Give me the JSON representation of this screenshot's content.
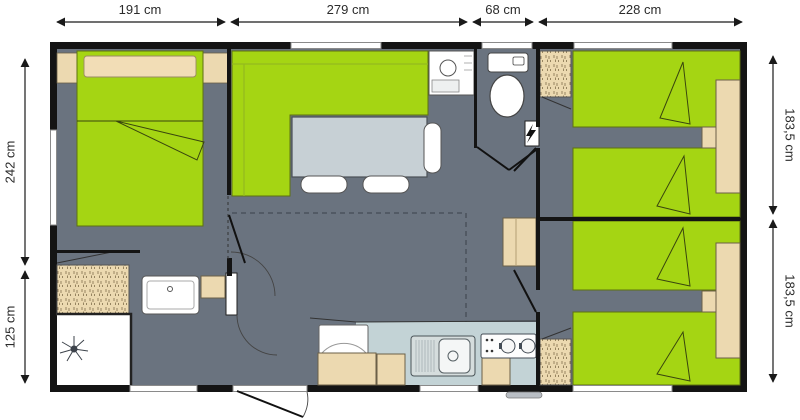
{
  "title": "Mobil-home floor plan",
  "dimensions": {
    "top": [
      "191 cm",
      "279 cm",
      "68 cm",
      "228 cm"
    ],
    "left": [
      "242 cm",
      "125 cm"
    ],
    "right": [
      "183,5 cm",
      "183,5 cm"
    ]
  },
  "icons": {
    "electrical_panel": "lightning-bolt",
    "shower": "shower-rose",
    "toilet": "wc-top-view",
    "washbasin": "basin-top-view",
    "hob": "two-burner-stove",
    "sink": "kitchen-sink-drainboard"
  },
  "colors": {
    "green": "#a5d513",
    "floor": "#6a737f",
    "beige": "#ecd9b0",
    "pillow": "#f2ddb6",
    "counter": "#c3d3d6",
    "steel": "#d5dddd",
    "table": "#c7d0d5",
    "wall": "#141414",
    "white": "#ffffff"
  }
}
